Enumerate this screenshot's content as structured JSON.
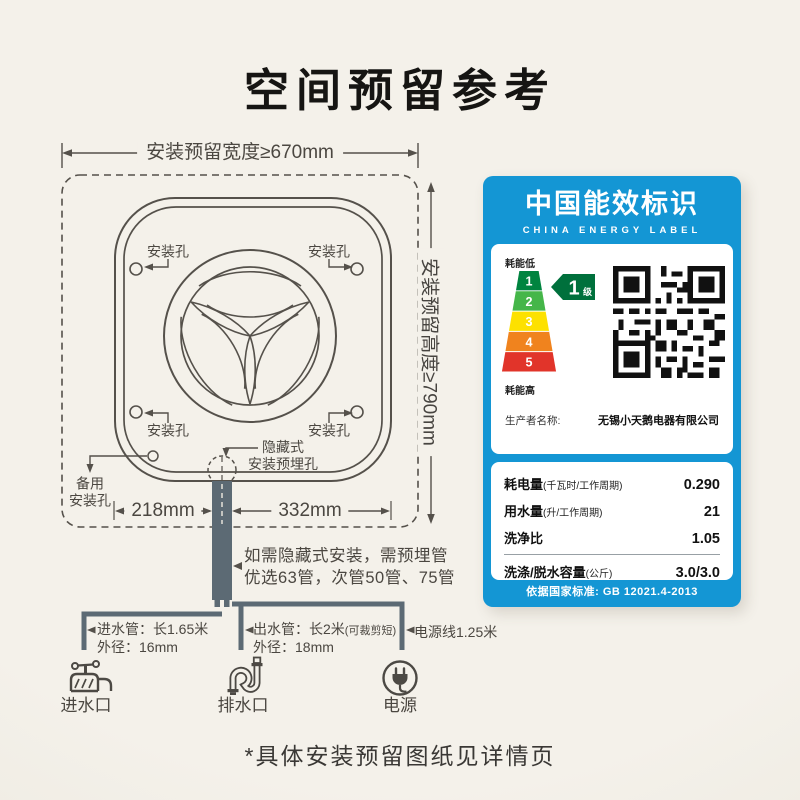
{
  "title": "空间预留参考",
  "footnote": "*具体安装预留图纸见详情页",
  "diagram": {
    "width_dim": "安装预留宽度≥670mm",
    "height_dim": "安装预留高度≥790mm",
    "hole_label": "安装孔",
    "hidden_hole_l1": "隐藏式",
    "hidden_hole_l2": "安装预埋孔",
    "backup_l1": "备用",
    "backup_l2": "安装孔",
    "dim_left": "218mm",
    "dim_right": "332mm",
    "note_l1": "如需隐藏式安装，需预埋管",
    "note_l2": "优选63管，次管50管、75管",
    "inlet_l1": "进水管：长1.65米",
    "inlet_l2": "外径：16mm",
    "outlet_l1": "出水管：长2米",
    "outlet_l1_small": "(可裁剪短)",
    "outlet_l2": "外径：18mm",
    "power_l1": "电源线1.25米",
    "inlet_caption": "进水口",
    "drain_caption": "排水口",
    "power_caption": "电源"
  },
  "energy_label": {
    "title_cn": "中国能效标识",
    "title_en": "CHINA ENERGY LABEL",
    "low": "耗能低",
    "high": "耗能高",
    "levels": [
      "1",
      "2",
      "3",
      "4",
      "5"
    ],
    "level_colors": [
      "#00843f",
      "#45b649",
      "#fde100",
      "#f0831e",
      "#e1342a"
    ],
    "grade_number": "1",
    "grade_suffix": "级",
    "producer_label": "生产者名称:",
    "producer_value": "无锡小天鹅电器有限公司",
    "rows": [
      {
        "label": "耗电量",
        "unit": "(千瓦时/工作周期)",
        "value": "0.290"
      },
      {
        "label": "用水量",
        "unit": "(升/工作周期)",
        "value": "21"
      },
      {
        "label": "洗净比",
        "unit": "",
        "value": "1.05"
      },
      {
        "label": "洗涤/脱水容量",
        "unit": "(公斤)",
        "value": "3.0/3.0"
      }
    ],
    "standard": "依据国家标准: GB 12021.4-2013",
    "accent_blue": "#1496d4",
    "badge_green": "#00703c"
  }
}
